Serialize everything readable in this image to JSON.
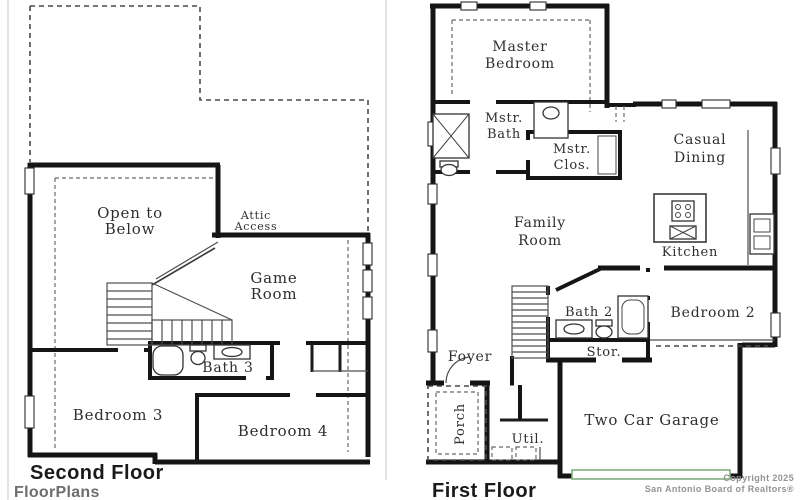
{
  "second_floor": {
    "title": "Second Floor",
    "caption": "FloorPlans",
    "labels": {
      "open_to_below": [
        "Open to",
        "Below"
      ],
      "attic_access": [
        "Attic",
        "Access"
      ],
      "game_room": [
        "Game",
        "Room"
      ],
      "bath_3": "Bath 3",
      "bedroom_3": "Bedroom 3",
      "bedroom_4": "Bedroom 4"
    }
  },
  "first_floor": {
    "title": "First Floor",
    "labels": {
      "master_bedroom": [
        "Master",
        "Bedroom"
      ],
      "mstr_bath": [
        "Mstr.",
        "Bath"
      ],
      "mstr_clos": [
        "Mstr.",
        "Clos."
      ],
      "casual_dining": [
        "Casual",
        "Dining"
      ],
      "family_room": [
        "Family",
        "Room"
      ],
      "kitchen": "Kitchen",
      "bath_2": "Bath 2",
      "bedroom_2": "Bedroom 2",
      "stor": "Stor.",
      "foyer": "Foyer",
      "porch": "Porch",
      "util": "Util.",
      "two_car_garage": "Two Car Garage"
    }
  },
  "footer": {
    "copyright_line1": "Copyright 2025",
    "copyright_line2": "San Antonio Board of Realtors®"
  },
  "colors": {
    "wall": "#151515",
    "label": "#2e2e2e",
    "garage_door_accent": "#7fae7f",
    "copyright_gray": "#939393"
  }
}
